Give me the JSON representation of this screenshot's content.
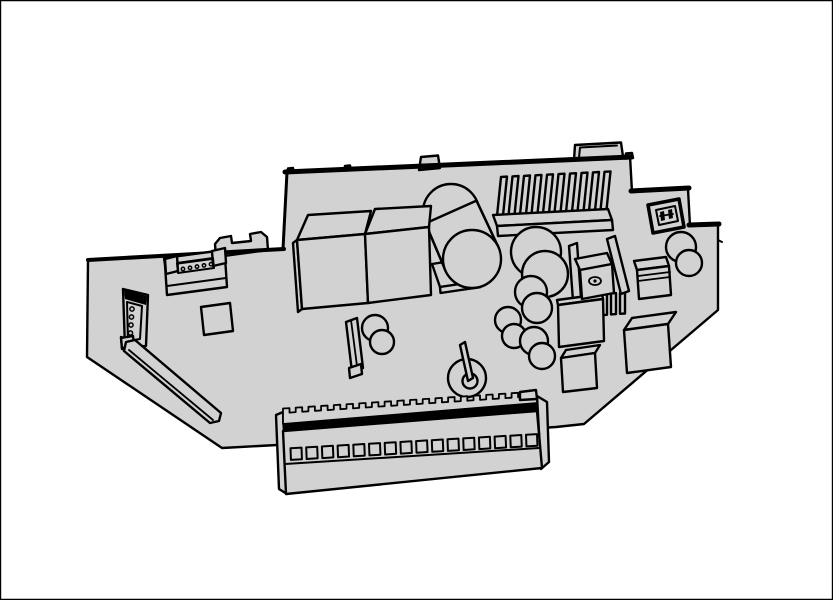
{
  "illustration": {
    "title": "isometric technical line drawing of a controller circuit board assembly",
    "style": "black outline line-art with flat light-gray fills on white background",
    "colors": {
      "background": "#ffffff",
      "board": "#d2d2d2",
      "line": "#000000",
      "black_fill": "#000000"
    },
    "board": {
      "shape": "stepped polygonal PCB viewed in isometric perspective",
      "edge_tabs": 3,
      "edge_nubs": 3
    },
    "components": [
      {
        "name": "pin-header-connector",
        "detail": "top-left header with 5 pin dots"
      },
      {
        "name": "bracket-tab",
        "detail": "two-prong clip tab on upper-left board edge"
      },
      {
        "name": "side-connector",
        "detail": "left-edge connector with 4 pins"
      },
      {
        "name": "diagonal-slot-bar",
        "detail": "long thin bar running to lower-left corner"
      },
      {
        "name": "ic-chip",
        "detail": "small square package"
      },
      {
        "name": "relay-left",
        "detail": "large rectangular module"
      },
      {
        "name": "relay-right",
        "detail": "large rectangular module"
      },
      {
        "name": "large-capacitor",
        "detail": "big tilted cylinder"
      },
      {
        "name": "mounting-pad",
        "detail": "stacked plate with small hole under large capacitor"
      },
      {
        "name": "top-heatsink",
        "detail": "finned heatsink",
        "fin_count": 10
      },
      {
        "name": "jumper-connector",
        "detail": "small 2-pin connector, top right"
      },
      {
        "name": "small-capacitor-tilted",
        "detail": "short cylinder near right edge"
      },
      {
        "name": "film-capacitor-box",
        "detail": "boxy component with ridge lines"
      },
      {
        "name": "transistor-heatsink-assembly",
        "detail": "transistor with screw on finned heatsink",
        "fin_count": 6
      },
      {
        "name": "capacitor-cluster",
        "detail": "four overlapping-cylinder capacitors",
        "count": 4
      },
      {
        "name": "wire-loop-post",
        "detail": "ring with straight post, center bottom"
      },
      {
        "name": "cube-component-small"
      },
      {
        "name": "cube-component-large"
      },
      {
        "name": "bracket-with-capacitor",
        "detail": "vertical plate with small cylinder"
      },
      {
        "name": "terminal-block",
        "detail": "long screw-terminal strip along bottom edge",
        "terminal_count": 16,
        "serration_teeth": 20
      }
    ]
  }
}
